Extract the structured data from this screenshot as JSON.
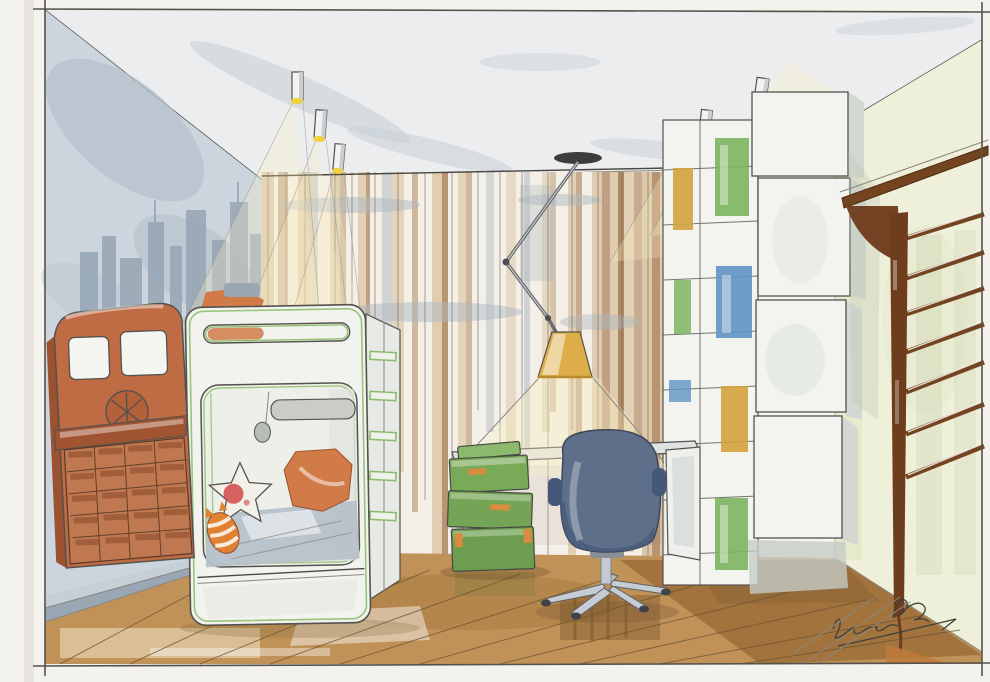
{
  "artwork": {
    "kind": "watercolor and ink interior sketch of a children's bedroom",
    "room": "children's bedroom",
    "signature_note": "illegible cursive artist signature, lower right corner"
  },
  "objects": {
    "left_wall": "blue-grey wall with painted city skyline silhouette",
    "truck_dresser": "terracotta truck-front cabinet with grid of small drawers",
    "bunk_bed": "white bunk-bed pod with green trim, orange pillows, star cushion and striped cat plush",
    "curtains": "floor-to-ceiling striped curtains in cream, tan and brown",
    "pendant_lamp": "articulated ceiling lamp with amber shade over the desk",
    "desk": "white desk with thin legs",
    "office_chair": "blue-grey swivel chair on chrome five-star base",
    "green_boxes": "stack of green storage boxes with orange clasps",
    "shelving": "white modular cube shelving with green, yellow and blue back panels",
    "wall_bars": "dark brown wooden gymnastic wall bars on pale yellow-green wall",
    "ceiling_lights": "cylindrical track spotlights with yellow glow and sketched light cones",
    "floor": "warm brown wooden plank floor with watercolor reflections"
  },
  "palette": {
    "paper": "#f7f5f0",
    "margin": "#f4f2ec",
    "ink": "#4a4843",
    "pencil": "#8a877e",
    "wallBlue": "#ccd5dd",
    "skyline": "#96a5b5",
    "wallYellow": "#eef0d9",
    "ceiling": "#ecedee",
    "smudge": "#c5cdd5",
    "curtain": "#f5f0e7",
    "tan": "#d9c2a0",
    "cbrown": "#a97d54",
    "cgray": "#aeb8c1",
    "floor": "#c09258",
    "floorDark": "#8d5f2b",
    "floorLight": "#e6d2ae",
    "truck": "#bf6b44",
    "truckDark": "#a05431",
    "bed": "#f2f3ee",
    "bedgreen": "#8abb66",
    "pillow": "#d07b48",
    "bedding": "#b7c1ca",
    "chair": "#5d6f89",
    "chairDark": "#46587a",
    "chrome": "#c3cad3",
    "boxgreen": "#78aa58",
    "boxclasp": "#d98c3f",
    "shelf": "#f3f4f0",
    "shelfShade": "#d3d9d2",
    "pGreen": "#7cb55e",
    "pYellow": "#d4a23c",
    "pBlue": "#5f93c4",
    "wood": "#74431f",
    "lampshade": "#ddad4a",
    "glow": "#f0d23c",
    "beam": "#f8eec2",
    "sig": "#3f3f3c"
  }
}
